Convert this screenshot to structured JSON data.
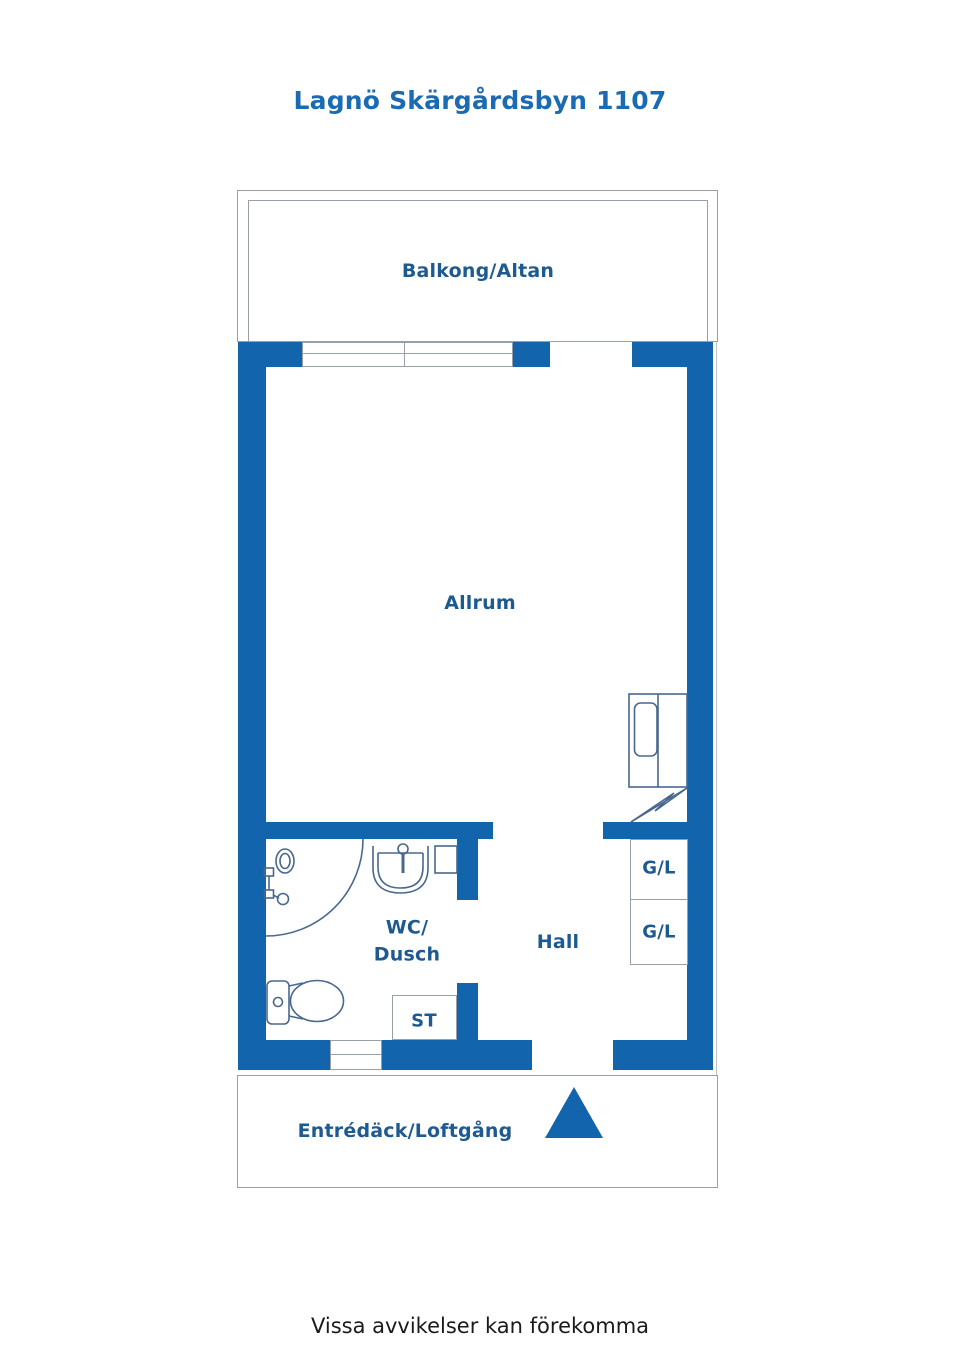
{
  "title": "Lagnö Skärgårdsbyn 1107",
  "disclaimer": "Vissa avvikelser kan förekomma",
  "rooms": {
    "balcony": "Balkong/Altan",
    "living": "Allrum",
    "wc_line1": "WC/",
    "wc_line2": "Dusch",
    "hall": "Hall",
    "closet_top": "G/L",
    "closet_bottom": "G/L",
    "cleaning_closet": "ST",
    "entrance_deck": "Entrédäck/Loftgång"
  },
  "symbols": {
    "entrance_arrow": "filled-triangle-up",
    "toilet": "toilet-outline",
    "shower": "shower-head-with-arc",
    "washbasin": "sink-bowl-with-tap",
    "wardrobe_unit": "closet-with-door",
    "heater": "zigzag-bolt",
    "window": "double-line-window"
  },
  "colors": {
    "background": "#ffffff",
    "wall": "#1264ad",
    "title_text": "#1a6bb4",
    "label_text": "#1d5a92",
    "fixture_line": "#49688f",
    "outline": "#97a0a8",
    "disclaimer_text": "#1a1a1a"
  }
}
